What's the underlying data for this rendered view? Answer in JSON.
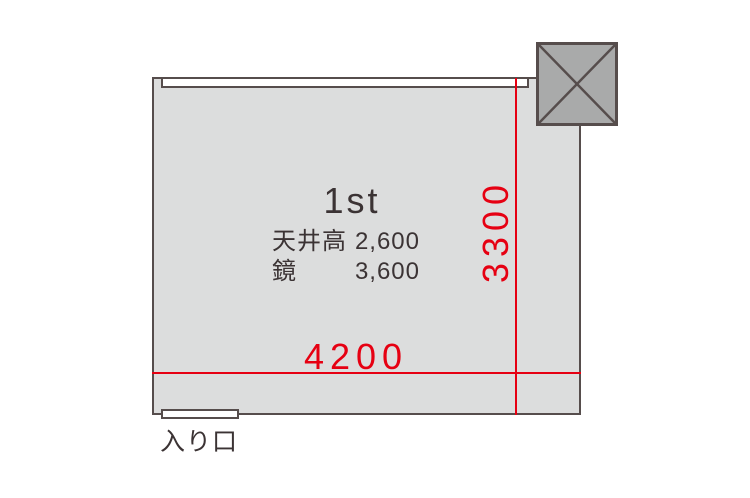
{
  "floorplan": {
    "room_name": "1st",
    "specs": [
      {
        "label": "天井高",
        "value": "2,600"
      },
      {
        "label": "鏡",
        "value": "3,600"
      }
    ],
    "dimensions": {
      "width_label": "4200",
      "depth_label": "3300"
    },
    "entrance_label": "入り口",
    "icons": {
      "column": "column-x-icon"
    },
    "colors": {
      "dimension_red": "#e60012",
      "room_fill": "#dcdddd",
      "wall": "#564d4c",
      "column_fill": "#a9aaaa",
      "text_dark": "#3b3334"
    }
  }
}
